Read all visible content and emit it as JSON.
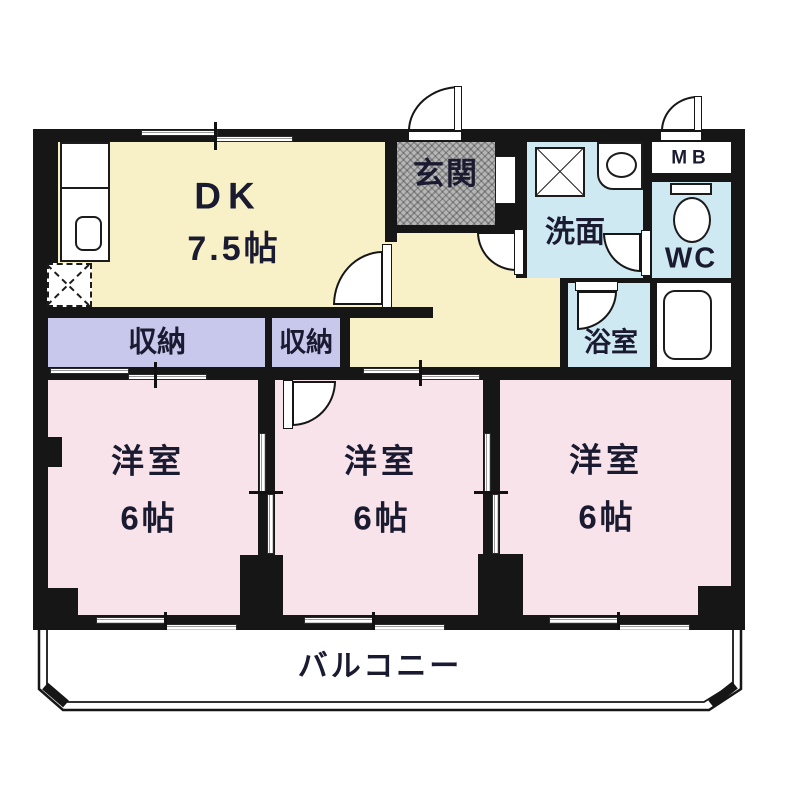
{
  "labels": {
    "dk": {
      "name": "DK",
      "size": "7.5帖"
    },
    "genkan": "玄関",
    "closet1": "収納",
    "closet2": "収納",
    "washroom": "洗面",
    "meter_box": "MB",
    "wc": "WC",
    "bathroom": "浴室",
    "bedroom1": {
      "name": "洋室",
      "size": "6帖"
    },
    "bedroom2": {
      "name": "洋室",
      "size": "6帖"
    },
    "bedroom3": {
      "name": "洋室",
      "size": "6帖"
    },
    "balcony": "バルコニー"
  },
  "colors": {
    "wall": "#161616",
    "line": "#161616",
    "dk-yellow": "#f8f1c8",
    "bedroom-pink": "#f9e3ea",
    "closet-lavender": "#c8c8ec",
    "wet-blue": "#cfe9f3",
    "genkan-gray": "#b6b6b6",
    "text": "#1a1a30"
  }
}
